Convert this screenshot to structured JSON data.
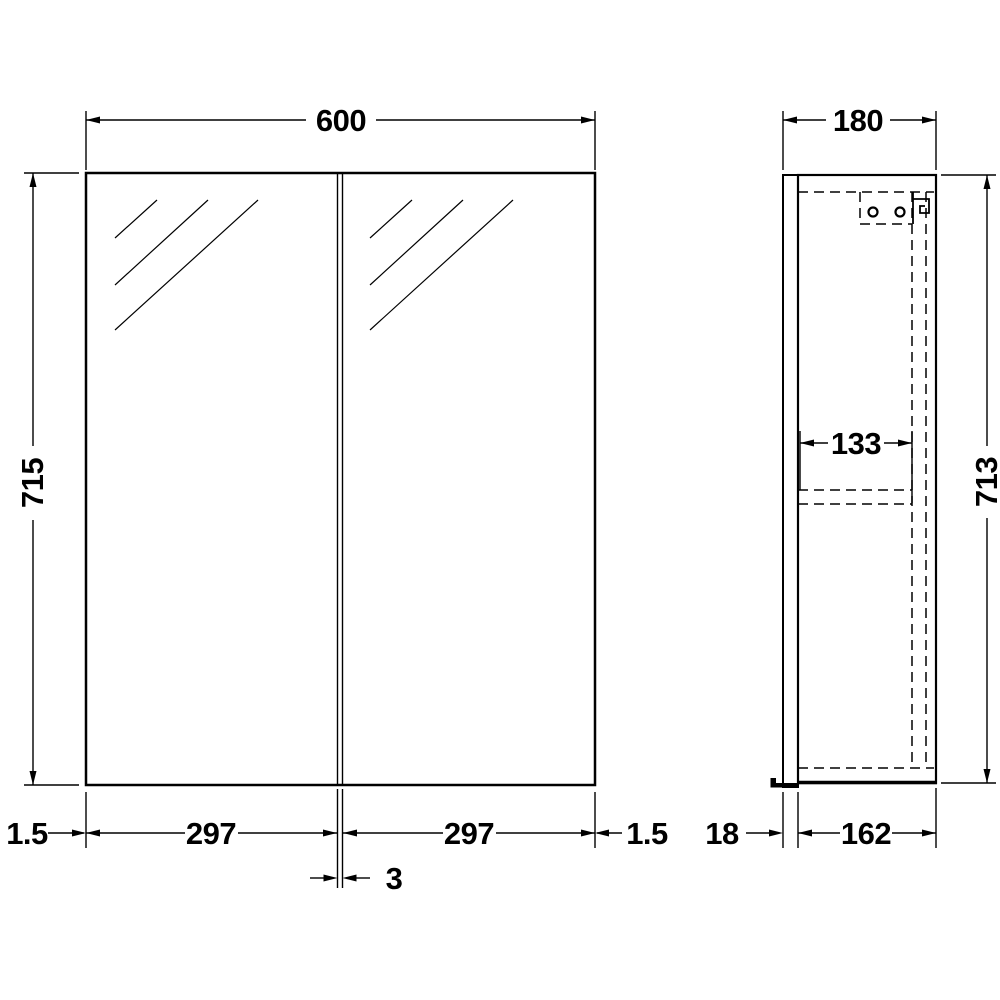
{
  "front_view": {
    "width": "600",
    "height": "715",
    "left_edge": "1.5",
    "left_door": "297",
    "door_gap": "3",
    "right_door": "297",
    "right_edge": "1.5"
  },
  "side_view": {
    "depth": "180",
    "height": "713",
    "internal_depth": "133",
    "door_thickness": "18",
    "body_depth": "162"
  },
  "colors": {
    "line": "#000000",
    "background": "#ffffff"
  }
}
